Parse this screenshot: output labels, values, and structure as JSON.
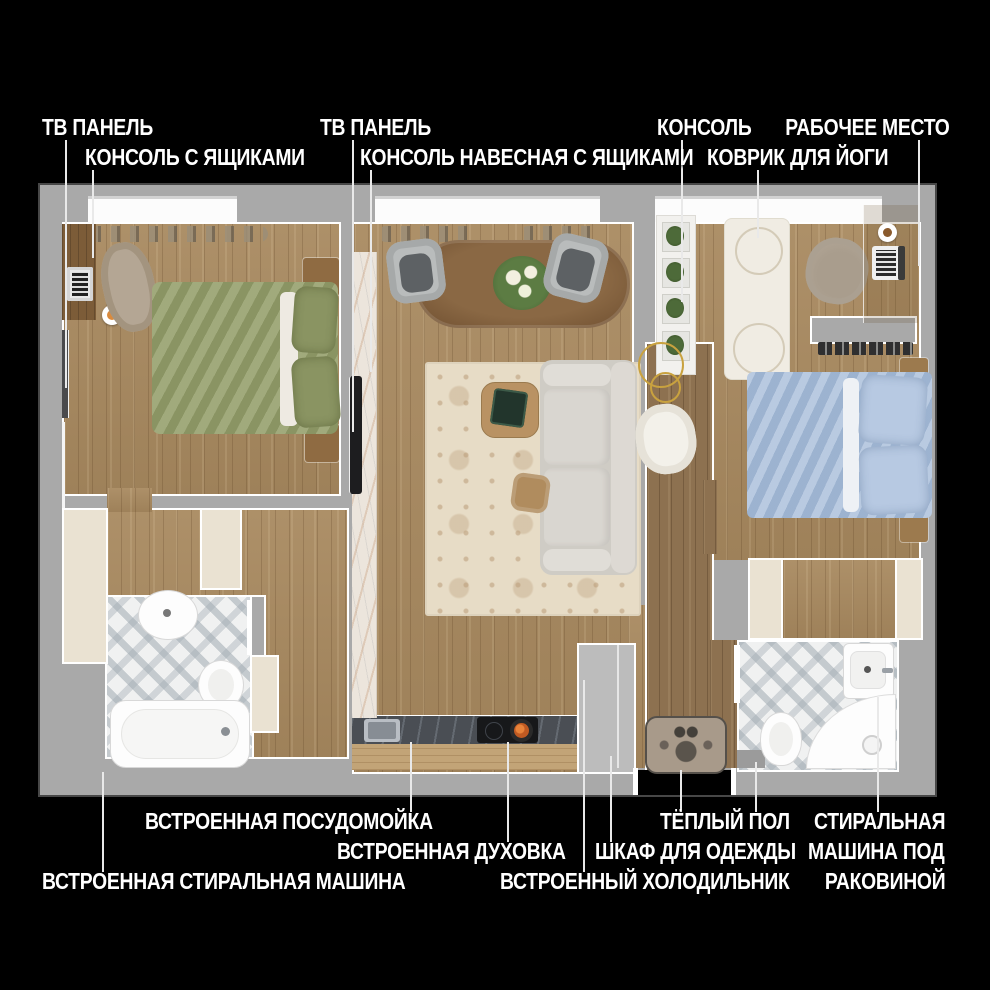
{
  "title": "Floor plan of a two-room apartment with annotated furniture (Russian)",
  "colors": {
    "background": "#000000",
    "wall": "#a9a9a9",
    "label_text": "#ffffff",
    "leader_line": "#e9e9e9",
    "wood_floor": "#a8895f",
    "hall_floor": "#8d7150",
    "tile": "#f0f1f1",
    "beige_cabinet": "#eae2d2",
    "counter_dark": "#4a4e54",
    "marble_console": "#ece5dc",
    "green_bed": "#96a06d",
    "blue_bed": "#aabfdb",
    "sofa": "#d8d5cf",
    "living_rug": "#e7dcc6",
    "owl_rug": "#a89a8a",
    "accent_gold": "#c9a23f"
  },
  "labels": {
    "tv_panel_left": "ТВ ПАНЕЛЬ",
    "console_with_drawers": "КОНСОЛЬ С ЯЩИКАМИ",
    "tv_panel_center": "ТВ ПАНЕЛЬ",
    "console_wall_mounted": "КОНСОЛЬ НАВЕСНАЯ С ЯЩИКАМИ",
    "console_plants": "КОНСОЛЬ",
    "yoga_mat": "КОВРИК ДЛЯ ЙОГИ",
    "workplace": "РАБОЧЕЕ МЕСТО",
    "dishwasher": "ВСТРОЕННАЯ ПОСУДОМОЙКА",
    "oven": "ВСТРОЕННАЯ ДУХОВКА",
    "washing_machine_built_in": "ВСТРОЕННАЯ СТИРАЛЬНАЯ МАШИНА",
    "fridge_built_in": "ВСТРОЕННЫЙ ХОЛОДИЛЬНИК",
    "wardrobe": "ШКАФ ДЛЯ ОДЕЖДЫ",
    "warm_floor": "ТЁПЛЫЙ ПОЛ",
    "washer_under_sink_line1": "СТИРАЛЬНАЯ",
    "washer_under_sink_line2": "МАШИНА ПОД",
    "washer_under_sink_line3": "РАКОВИНОЙ"
  }
}
